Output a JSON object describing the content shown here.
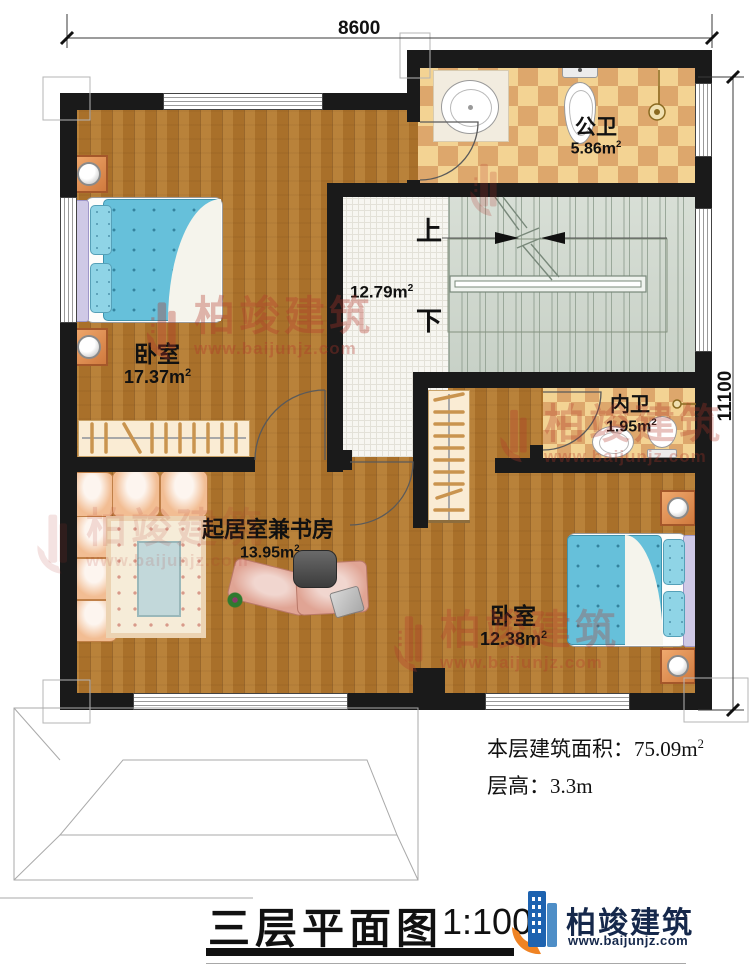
{
  "dimensions": {
    "top": "8600",
    "right": "11100"
  },
  "rooms": [
    {
      "name": "bedroom-1",
      "label": "卧室",
      "area_value": "17.37m",
      "area_sup": "2"
    },
    {
      "name": "public-bathroom",
      "label": "公卫",
      "area_value": "5.86m",
      "area_sup": "2"
    },
    {
      "name": "hallway",
      "label": "",
      "area_value": "12.79m",
      "area_sup": "2"
    },
    {
      "name": "inner-bathroom",
      "label": "内卫",
      "area_value": "1.95m",
      "area_sup": "2"
    },
    {
      "name": "living-study",
      "label": "起居室兼书房",
      "area_value": "13.95m",
      "area_sup": "2"
    },
    {
      "name": "bedroom-2",
      "label": "卧室",
      "area_value": "12.38m",
      "area_sup": "2"
    }
  ],
  "stairs": {
    "up": "上",
    "down": "下"
  },
  "footer": {
    "area_prefix": "本层建筑面积：",
    "area_value": "75.09m",
    "area_sup": "2",
    "height_line": "层高：3.3m"
  },
  "title": {
    "text": "三层平面图",
    "scale": "1:100"
  },
  "brand": {
    "name": "柏竣建筑",
    "url": "www.baijunjz.com"
  },
  "watermark": {
    "name": "柏竣建筑",
    "url": "www.baijunjz.com"
  },
  "colors": {
    "wall": "#1a1a1a",
    "wood": "#b1772f",
    "tile_light": "#f3d393",
    "tile_dark": "#dda76c",
    "stairs": "#cfd8ce",
    "watermark_red": "#b43428",
    "brand_blue": "#1e63b0",
    "brand_orange": "#ef8324"
  }
}
